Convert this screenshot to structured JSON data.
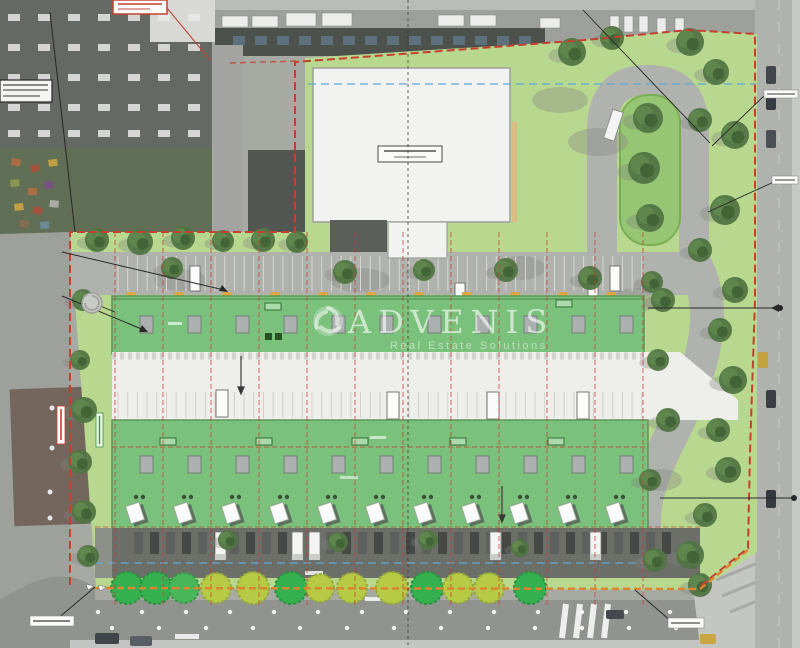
{
  "watermark": {
    "logo": "swirl-icon",
    "title": "ADVENIS",
    "subtitle": "Real Estate Solutions"
  },
  "annotations": {
    "top_left_red_box": {
      "label": "",
      "legible": false
    },
    "left_black_box": {
      "label": "",
      "legible": false
    },
    "building_label_box": {
      "label": "",
      "legible": false
    },
    "right_street_label_1": {
      "label": "",
      "legible": false
    },
    "right_street_label_2": {
      "label": "",
      "legible": false
    },
    "bottom_left_label": {
      "label": "",
      "legible": false
    },
    "bottom_right_label": {
      "label": "",
      "legible": false
    }
  },
  "palette": {
    "boundary_red": "#c23b2b",
    "boundary_orange": "#d9822b",
    "lawn_green": "#b7d78c",
    "roof_green": "#76bf78",
    "roof_edge": "#569653",
    "tree_bright": "#2fae4a",
    "tree_yellow": "#b5c93f",
    "road_gray": "#aeb0ac",
    "yard_dark": "#686a64",
    "building_white": "#f2f2f0",
    "guide_blue": "#5aa7d6",
    "curb_yellow": "#dca63e",
    "skylight_gray": "#a9afae"
  },
  "plan": {
    "unit_grid_x": [
      115,
      163,
      211,
      259,
      307,
      355,
      403,
      451,
      499,
      547,
      595,
      643
    ],
    "skylight_xs": [
      140,
      188,
      236,
      284,
      332,
      380,
      428,
      476,
      524,
      572,
      620
    ],
    "vent_xs": [
      136,
      184,
      232,
      280,
      328,
      376,
      424,
      472,
      520,
      568,
      616
    ],
    "window_xs": [
      128,
      176,
      224,
      272,
      320,
      368,
      416,
      464,
      512,
      560,
      608
    ],
    "upper_tags": [
      {
        "x": 265,
        "y": 303
      },
      {
        "x": 556,
        "y": 300
      }
    ],
    "lower_tags": [
      {
        "x": 160,
        "y": 438
      },
      {
        "x": 256,
        "y": 438
      },
      {
        "x": 352,
        "y": 438
      },
      {
        "x": 450,
        "y": 438
      },
      {
        "x": 548,
        "y": 438
      }
    ],
    "curb_ticks_x": [
      126,
      174,
      222,
      270,
      318,
      366,
      414,
      462,
      510,
      558,
      606,
      654
    ],
    "bottom_trees": [
      {
        "x": 127,
        "r": 16,
        "c": "#2fae4a",
        "s": "#1f8f38"
      },
      {
        "x": 156,
        "r": 16,
        "c": "#2fae4a",
        "s": "#1f8f38"
      },
      {
        "x": 184,
        "r": 15,
        "c": "#45b455",
        "s": "#2f9440"
      },
      {
        "x": 216,
        "r": 15,
        "c": "#b5c93f",
        "s": "#93a832"
      },
      {
        "x": 253,
        "r": 16,
        "c": "#b5c93f",
        "s": "#93a832"
      },
      {
        "x": 291,
        "r": 16,
        "c": "#2fae4a",
        "s": "#1f8f38"
      },
      {
        "x": 320,
        "r": 14,
        "c": "#b5c93f",
        "s": "#93a832"
      },
      {
        "x": 352,
        "r": 15,
        "c": "#b5c93f",
        "s": "#93a832"
      },
      {
        "x": 392,
        "r": 16,
        "c": "#b5c93f",
        "s": "#93a832"
      },
      {
        "x": 427,
        "r": 16,
        "c": "#2fae4a",
        "s": "#1f8f38"
      },
      {
        "x": 458,
        "r": 15,
        "c": "#b5c93f",
        "s": "#93a832"
      },
      {
        "x": 489,
        "r": 15,
        "c": "#b5c93f",
        "s": "#93a832"
      },
      {
        "x": 530,
        "r": 16,
        "c": "#2fae4a",
        "s": "#1f8f38"
      }
    ],
    "bottom_trees_y": 588,
    "yard_trucks": [
      {
        "x": 215
      },
      {
        "x": 292
      },
      {
        "x": 309
      },
      {
        "x": 490
      },
      {
        "x": 590
      }
    ],
    "road_vans": [
      {
        "x": 190,
        "y": 266
      },
      {
        "x": 455,
        "y": 283
      },
      {
        "x": 588,
        "y": 283
      },
      {
        "x": 610,
        "y": 266
      }
    ],
    "stall_vans": [
      {
        "x": 216,
        "y": 390
      },
      {
        "x": 387,
        "y": 392
      },
      {
        "x": 487,
        "y": 392
      },
      {
        "x": 577,
        "y": 392
      }
    ],
    "bollards_row1": {
      "y": 612,
      "x0": 98,
      "dx": 44,
      "n": 14
    },
    "bollards_row2": {
      "y": 628,
      "x0": 112,
      "dx": 47,
      "n": 13
    },
    "real_trees": [
      {
        "x": 97,
        "y": 240,
        "r": 12
      },
      {
        "x": 140,
        "y": 242,
        "r": 13
      },
      {
        "x": 183,
        "y": 238,
        "r": 12
      },
      {
        "x": 223,
        "y": 241,
        "r": 11
      },
      {
        "x": 263,
        "y": 240,
        "r": 12
      },
      {
        "x": 297,
        "y": 242,
        "r": 11
      },
      {
        "x": 172,
        "y": 268,
        "r": 11
      },
      {
        "x": 345,
        "y": 272,
        "r": 12
      },
      {
        "x": 424,
        "y": 270,
        "r": 11
      },
      {
        "x": 506,
        "y": 270,
        "r": 12
      },
      {
        "x": 590,
        "y": 278,
        "r": 12
      },
      {
        "x": 652,
        "y": 282,
        "r": 11
      },
      {
        "x": 572,
        "y": 52,
        "r": 14
      },
      {
        "x": 612,
        "y": 38,
        "r": 12
      },
      {
        "x": 690,
        "y": 42,
        "r": 14
      },
      {
        "x": 716,
        "y": 72,
        "r": 13
      },
      {
        "x": 700,
        "y": 120,
        "r": 12
      },
      {
        "x": 735,
        "y": 135,
        "r": 14
      },
      {
        "x": 725,
        "y": 210,
        "r": 15
      },
      {
        "x": 700,
        "y": 250,
        "r": 12
      },
      {
        "x": 648,
        "y": 118,
        "r": 15
      },
      {
        "x": 644,
        "y": 168,
        "r": 16
      },
      {
        "x": 650,
        "y": 218,
        "r": 14
      },
      {
        "x": 735,
        "y": 290,
        "r": 13
      },
      {
        "x": 720,
        "y": 330,
        "r": 12
      },
      {
        "x": 733,
        "y": 380,
        "r": 14
      },
      {
        "x": 718,
        "y": 430,
        "r": 12
      },
      {
        "x": 728,
        "y": 470,
        "r": 13
      },
      {
        "x": 705,
        "y": 515,
        "r": 12
      },
      {
        "x": 690,
        "y": 555,
        "r": 14
      },
      {
        "x": 655,
        "y": 560,
        "r": 12
      },
      {
        "x": 663,
        "y": 300,
        "r": 12
      },
      {
        "x": 658,
        "y": 360,
        "r": 11
      },
      {
        "x": 668,
        "y": 420,
        "r": 12
      },
      {
        "x": 650,
        "y": 480,
        "r": 11
      },
      {
        "x": 83,
        "y": 300,
        "r": 11
      },
      {
        "x": 80,
        "y": 360,
        "r": 10
      },
      {
        "x": 84,
        "y": 410,
        "r": 13
      },
      {
        "x": 80,
        "y": 462,
        "r": 12
      },
      {
        "x": 84,
        "y": 512,
        "r": 12
      },
      {
        "x": 88,
        "y": 556,
        "r": 11
      },
      {
        "x": 228,
        "y": 540,
        "r": 10
      },
      {
        "x": 338,
        "y": 542,
        "r": 10
      },
      {
        "x": 428,
        "y": 540,
        "r": 10
      },
      {
        "x": 520,
        "y": 548,
        "r": 9
      },
      {
        "x": 700,
        "y": 585,
        "r": 12
      },
      {
        "x": 838,
        "y": 0,
        "r": 0
      }
    ],
    "road_shadows": [
      [
        598,
        142,
        30,
        14
      ],
      [
        636,
        300,
        24,
        12
      ],
      [
        520,
        268,
        26,
        12
      ],
      [
        360,
        280,
        30,
        12
      ],
      [
        180,
        280,
        26,
        11
      ],
      [
        660,
        480,
        22,
        11
      ],
      [
        620,
        545,
        24,
        11
      ],
      [
        560,
        100,
        28,
        13
      ]
    ]
  },
  "aerial": {
    "tl_skylight_rows": [
      14,
      44,
      74,
      104,
      130
    ],
    "tl_skylight_x0": 8,
    "tl_skylight_dx": 30,
    "tl_skylight_n": 7,
    "top_cars": [
      [
        222,
        16,
        26,
        11
      ],
      [
        252,
        16,
        26,
        11
      ],
      [
        286,
        13,
        30,
        13
      ],
      [
        322,
        13,
        30,
        13
      ],
      [
        438,
        15,
        26,
        11
      ],
      [
        470,
        15,
        26,
        11
      ],
      [
        540,
        18,
        20,
        10
      ],
      [
        610,
        16,
        9,
        16
      ],
      [
        624,
        16,
        9,
        16
      ],
      [
        639,
        16,
        9,
        16
      ],
      [
        657,
        18,
        9,
        16
      ],
      [
        675,
        18,
        9,
        16
      ]
    ],
    "band_windows": {
      "x0": 233,
      "dx": 22,
      "n": 14,
      "y": 36
    },
    "right_cars": [
      [
        766,
        66,
        10,
        18,
        "#3c4248"
      ],
      [
        766,
        92,
        10,
        18,
        "#2f353b"
      ],
      [
        766,
        130,
        10,
        18,
        "#454b51"
      ],
      [
        758,
        352,
        10,
        16,
        "#c2a23a"
      ],
      [
        766,
        390,
        10,
        18,
        "#33393f"
      ],
      [
        766,
        490,
        10,
        18,
        "#2e343a"
      ]
    ],
    "bottom_cars": [
      [
        95,
        633,
        24,
        11,
        "#3a3f45"
      ],
      [
        130,
        636,
        22,
        10,
        "#54595f"
      ],
      [
        606,
        610,
        18,
        9,
        "#3f444a"
      ],
      [
        700,
        634,
        16,
        10,
        "#c8a43c"
      ]
    ],
    "clutter": [
      [
        12,
        158,
        "#b06a3a"
      ],
      [
        30,
        166,
        "#a84a32"
      ],
      [
        48,
        160,
        "#c9a23c"
      ],
      [
        10,
        180,
        "#8a9a4a"
      ],
      [
        28,
        188,
        "#b06a3a"
      ],
      [
        44,
        182,
        "#7a4a86"
      ],
      [
        14,
        204,
        "#c9a23c"
      ],
      [
        34,
        206,
        "#a84a32"
      ],
      [
        50,
        200,
        "#b0b0ac"
      ],
      [
        20,
        220,
        "#8a6a4a"
      ],
      [
        40,
        222,
        "#6a8a9a"
      ]
    ]
  }
}
